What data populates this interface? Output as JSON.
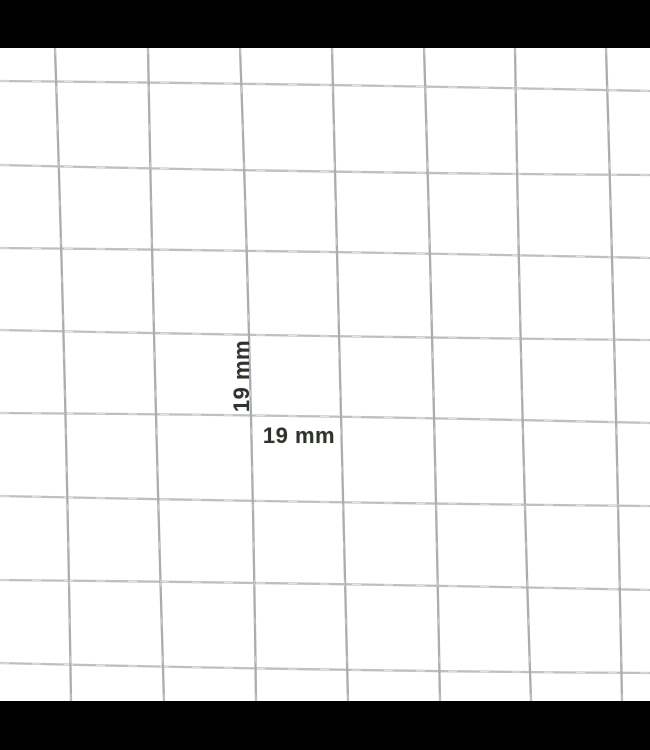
{
  "page": {
    "background_color": "#ffffff",
    "letterbox_color": "#000000"
  },
  "letterbox": {
    "top_height_px": 48,
    "bottom_height_px": 49
  },
  "product_image": {
    "alt": "Close-up photo of galvanised welded wire mesh with 19 mm square openings",
    "mesh": {
      "wire_color_vertical": "#a9acb0",
      "wire_color_horizontal": "#bdbfc3",
      "wire_highlight_color": "#ffffff",
      "wire_width": 2.3,
      "area_width": 650,
      "area_height": 653,
      "vertical_wires_x": [
        55,
        148,
        240,
        332,
        424,
        515,
        606
      ],
      "vertical_lean_px": 16,
      "vertical_bows": [
        3,
        -2,
        4,
        -1,
        2,
        -3,
        2
      ],
      "horizontal_wires_y": [
        33,
        117,
        200,
        282,
        365,
        448,
        532,
        615
      ],
      "horizontal_drop_px": 10,
      "horizontal_bows": [
        -2,
        3,
        -2,
        2,
        -3,
        2,
        -2,
        3
      ]
    },
    "annotations": {
      "label_color": "#2e332c",
      "font_size_px": 22,
      "vertical_label": {
        "text": "19 mm",
        "center_x": 242,
        "center_y": 328,
        "rotation_deg": -90
      },
      "horizontal_label": {
        "text": "19 mm",
        "center_x": 299,
        "center_y": 388
      }
    }
  }
}
